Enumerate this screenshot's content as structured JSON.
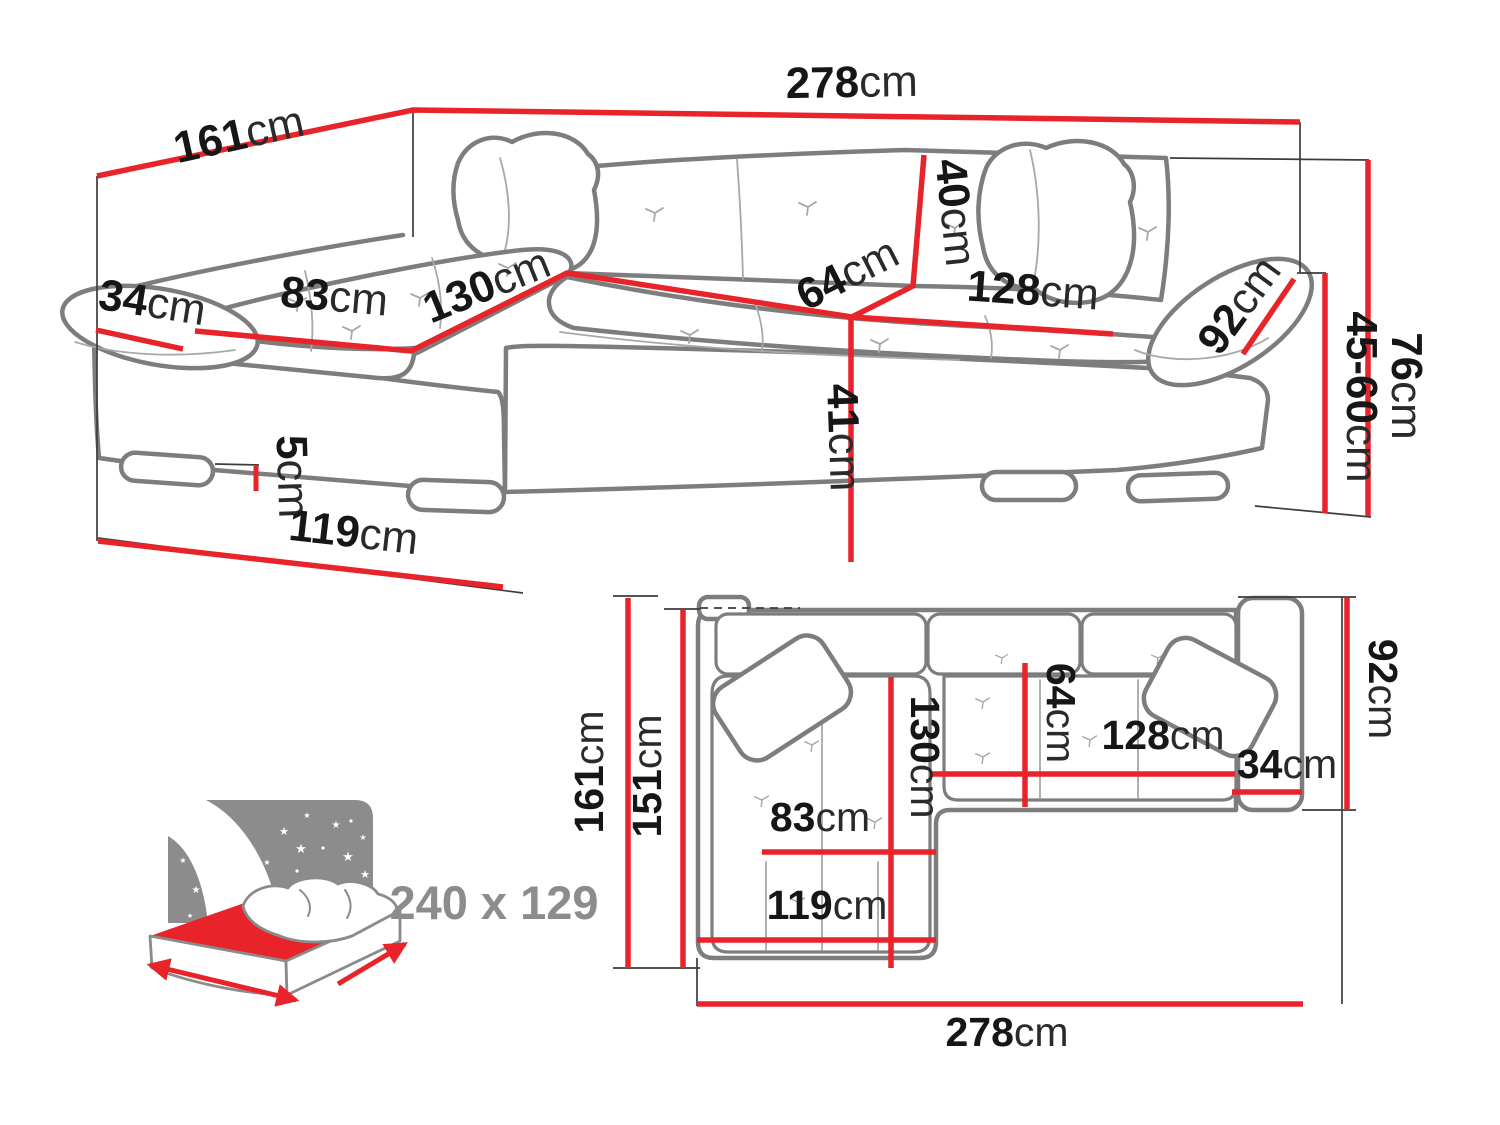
{
  "colors": {
    "dimension_red": "#e8232a",
    "sofa_outline_gray": "#7d7d7d",
    "reference_line_black": "#3c3c3c",
    "label_ink": "#161616",
    "muted_gray": "#8c8c8c"
  },
  "perspective": {
    "labels": {
      "total_depth": {
        "num": "161",
        "unit": "cm"
      },
      "total_width": {
        "num": "278",
        "unit": "cm"
      },
      "armrest_width": {
        "num": "34",
        "unit": "cm"
      },
      "chaise_seat_width": {
        "num": "83",
        "unit": "cm"
      },
      "chaise_length": {
        "num": "130",
        "unit": "cm"
      },
      "backrest_height": {
        "num": "40",
        "unit": "cm"
      },
      "seat_depth": {
        "num": "64",
        "unit": "cm"
      },
      "seat_width": {
        "num": "128",
        "unit": "cm"
      },
      "armrest_length": {
        "num": "92",
        "unit": "cm"
      },
      "seat_height": {
        "num": "45-60",
        "unit": "cm"
      },
      "total_height": {
        "num": "76",
        "unit": "cm"
      },
      "base_height": {
        "num": "41",
        "unit": "cm"
      },
      "leg_height": {
        "num": "5",
        "unit": "cm"
      },
      "chaise_outer_length": {
        "num": "119",
        "unit": "cm"
      }
    }
  },
  "plan": {
    "labels": {
      "depth_total": {
        "num": "161",
        "unit": "cm"
      },
      "depth_inner": {
        "num": "151",
        "unit": "cm"
      },
      "chaise_length": {
        "num": "130",
        "unit": "cm"
      },
      "seat_depth": {
        "num": "64",
        "unit": "cm"
      },
      "seat_width": {
        "num": "128",
        "unit": "cm"
      },
      "armrest_width": {
        "num": "34",
        "unit": "cm"
      },
      "armrest_length": {
        "num": "92",
        "unit": "cm"
      },
      "chaise_seat_width": {
        "num": "83",
        "unit": "cm"
      },
      "chaise_outer_length": {
        "num": "119",
        "unit": "cm"
      },
      "total_width": {
        "num": "278",
        "unit": "cm"
      }
    }
  },
  "sleeping": {
    "label": "240 x 129",
    "star_glyph": "★"
  }
}
